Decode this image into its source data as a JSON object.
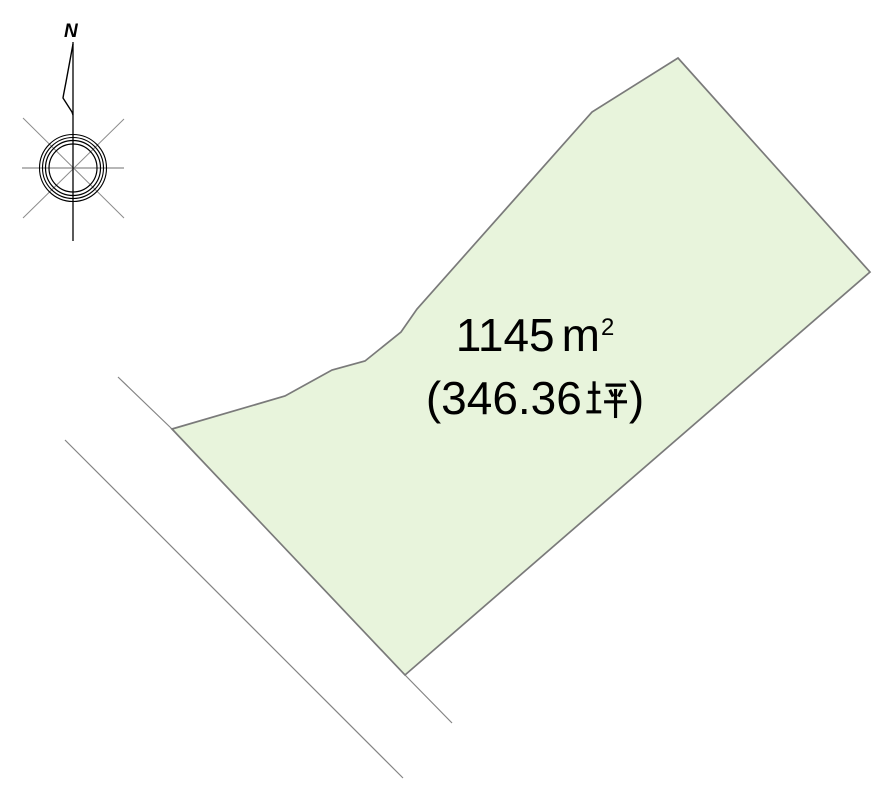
{
  "compass": {
    "north_label": "N"
  },
  "plot": {
    "area_m2": "1145㎡",
    "area_m2_value": "1145",
    "area_m2_unit_letter": "m",
    "area_m2_unit_exponent": "2",
    "area_tsubo": "(346.36坪)",
    "area_tsubo_prefix": "(346.36",
    "area_tsubo_unit": "坪",
    "area_tsubo_suffix": ")"
  },
  "colors": {
    "background": "#ffffff",
    "plot_fill": "#e8f4dc",
    "plot_outline": "#7a7a7a",
    "road_line": "#848484",
    "compass_axis": "#000000",
    "compass_cross": "#8c8c8c",
    "compass_circle": "#000000",
    "text": "#000000"
  }
}
